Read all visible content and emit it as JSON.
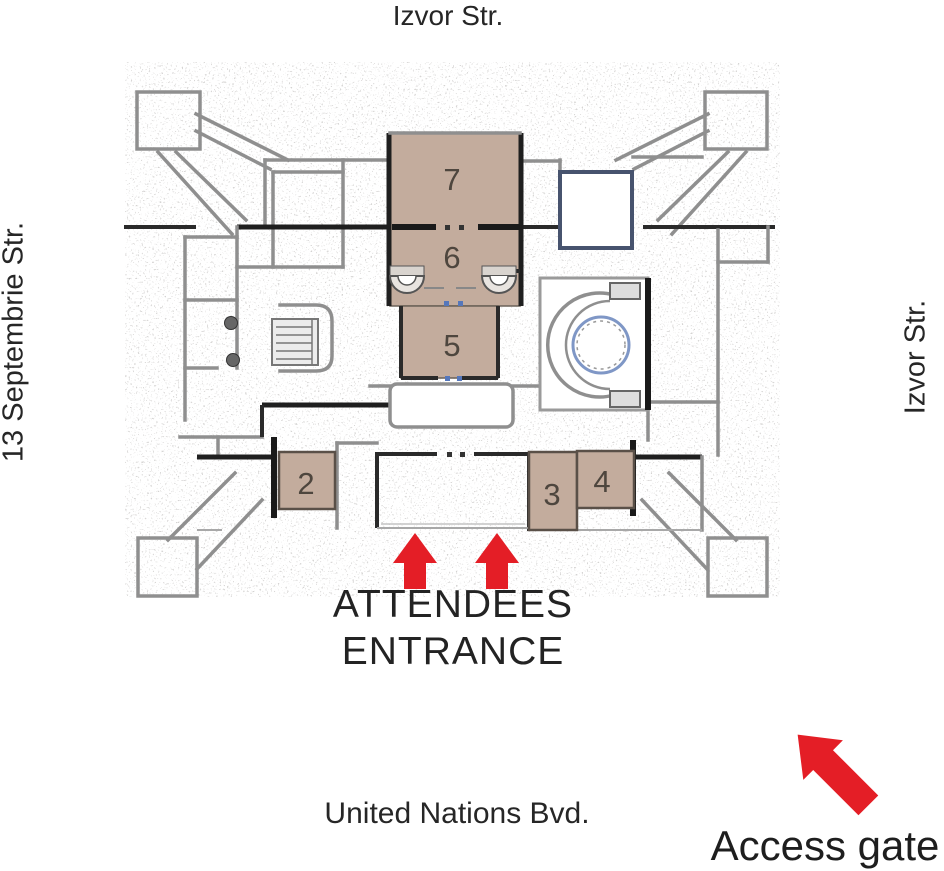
{
  "map": {
    "streets": {
      "top": "Izvor Str.",
      "left": "13 Septembrie Str.",
      "right": "Izvor Str.",
      "bottom": "United Nations Bvd."
    },
    "rooms": [
      "7",
      "6",
      "5",
      "2",
      "3",
      "4"
    ],
    "entrance": {
      "line1": "ATTENDEES",
      "line2": "ENTRANCE"
    },
    "access_gate_label": "Access gate",
    "colors": {
      "room_fill": "#c3ac9d",
      "room_border": "#5a5048",
      "arrow_red": "#e41e26",
      "wall_gray": "#8f8f8f",
      "wall_dark": "#1f1f1f",
      "ring_blue": "#7f97c6",
      "blue_room_wall": "#47536e",
      "text": "#262626"
    }
  }
}
